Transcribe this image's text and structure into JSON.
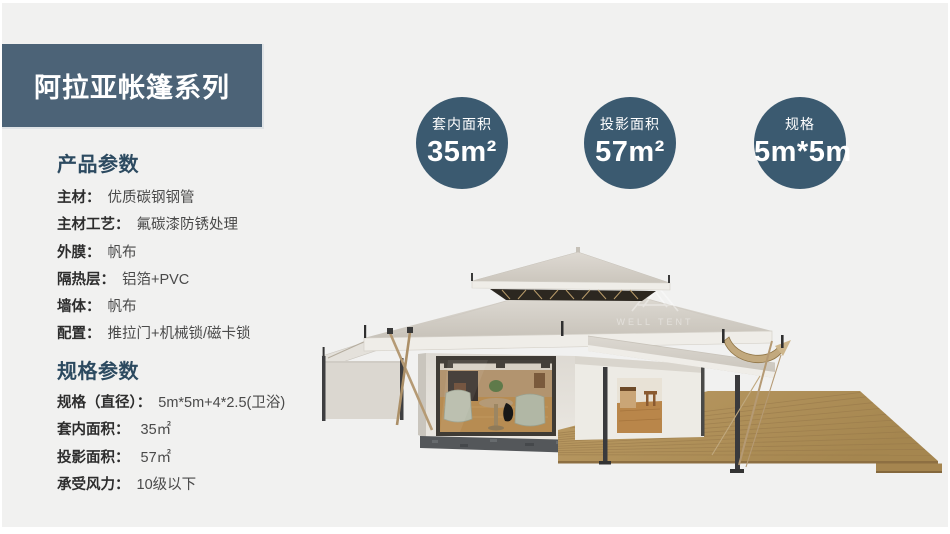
{
  "banner": {
    "title": "阿拉亚帐篷系列"
  },
  "colors": {
    "banner_bg": "#4c6377",
    "badge_bg": "#3b5a70",
    "heading": "#2c4a60",
    "page_bg": "#f1f1f0"
  },
  "product_params": {
    "heading": "产品参数",
    "rows": [
      {
        "label": "主材：",
        "value": "优质碳钢钢管"
      },
      {
        "label": "主材工艺：",
        "value": "氟碳漆防锈处理"
      },
      {
        "label": "外膜：",
        "value": "帆布"
      },
      {
        "label": "隔热层：",
        "value": "铝箔+PVC"
      },
      {
        "label": "墙体：",
        "value": "帆布"
      },
      {
        "label": "配置：",
        "value": "推拉门+机械锁/磁卡锁"
      }
    ]
  },
  "spec_params": {
    "heading": "规格参数",
    "rows": [
      {
        "label": "规格（直径）：",
        "value": "5m*5m+4*2.5(卫浴)"
      },
      {
        "label": "套内面积：",
        "value": " 35㎡"
      },
      {
        "label": "投影面积：",
        "value": " 57㎡"
      },
      {
        "label": "承受风力：",
        "value": "10级以下"
      }
    ]
  },
  "badges": [
    {
      "label": "套内面积",
      "value": "35m²"
    },
    {
      "label": "投影面积",
      "value": "57m²"
    },
    {
      "label": "规格",
      "value": "5m*5m"
    }
  ],
  "watermark": {
    "text": "WELL TENT"
  }
}
